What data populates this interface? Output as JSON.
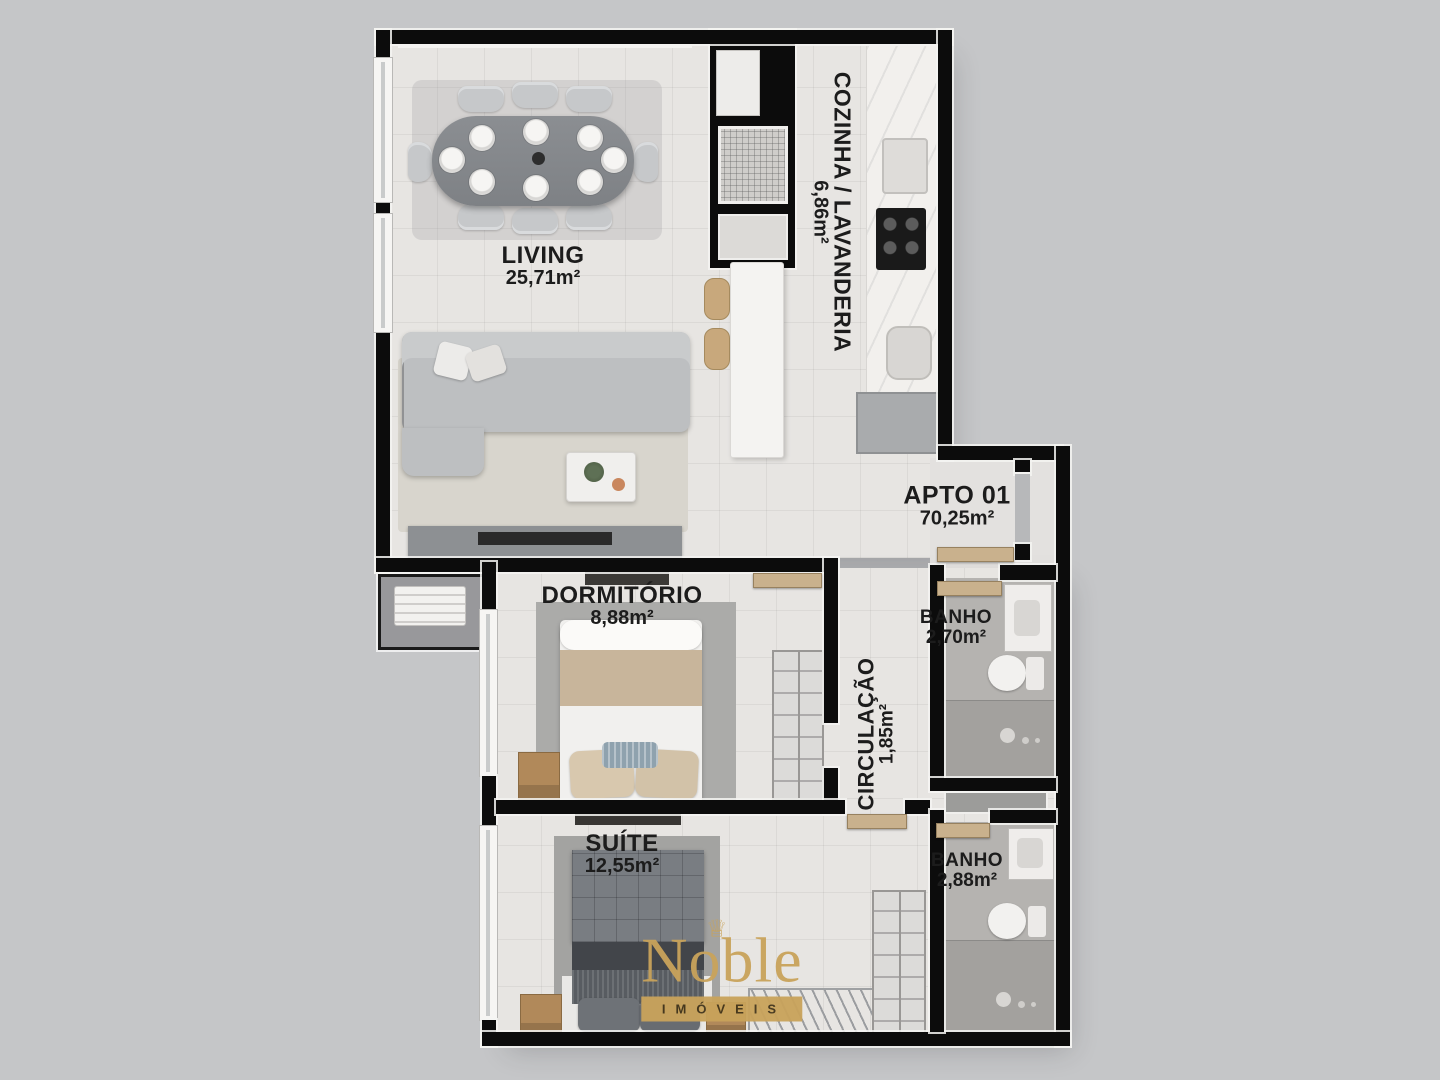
{
  "title": "Planta baixa APTO 01",
  "rooms": [
    {
      "id": "living",
      "name": "LIVING",
      "area": "25,71m²"
    },
    {
      "id": "cozinha",
      "name": "COZINHA / LAVANDERIA",
      "area": "6,86m²"
    },
    {
      "id": "apto",
      "name": "APTO 01",
      "area": "70,25m²"
    },
    {
      "id": "dormitorio",
      "name": "DORMITÓRIO",
      "area": "8,88m²"
    },
    {
      "id": "banho1",
      "name": "BANHO",
      "area": "2,70m²"
    },
    {
      "id": "circulacao",
      "name": "CIRCULAÇÃO",
      "area": "1,85m²"
    },
    {
      "id": "suite",
      "name": "SUÍTE",
      "area": "12,55m²"
    },
    {
      "id": "banho2",
      "name": "BANHO",
      "area": "2,88m²"
    }
  ],
  "logo": {
    "brand": "Noble",
    "tagline": "IMÓVEIS",
    "crown": "♕"
  },
  "colors": {
    "gold": "#C9A35B",
    "wall": "#0C0C0C",
    "background": "#C5C6C8",
    "floor_light": "#E7E5E2",
    "floor_bath": "#B5B3B0",
    "door_leaf": "#C9B18D",
    "label_text": "#1C1C1C"
  }
}
